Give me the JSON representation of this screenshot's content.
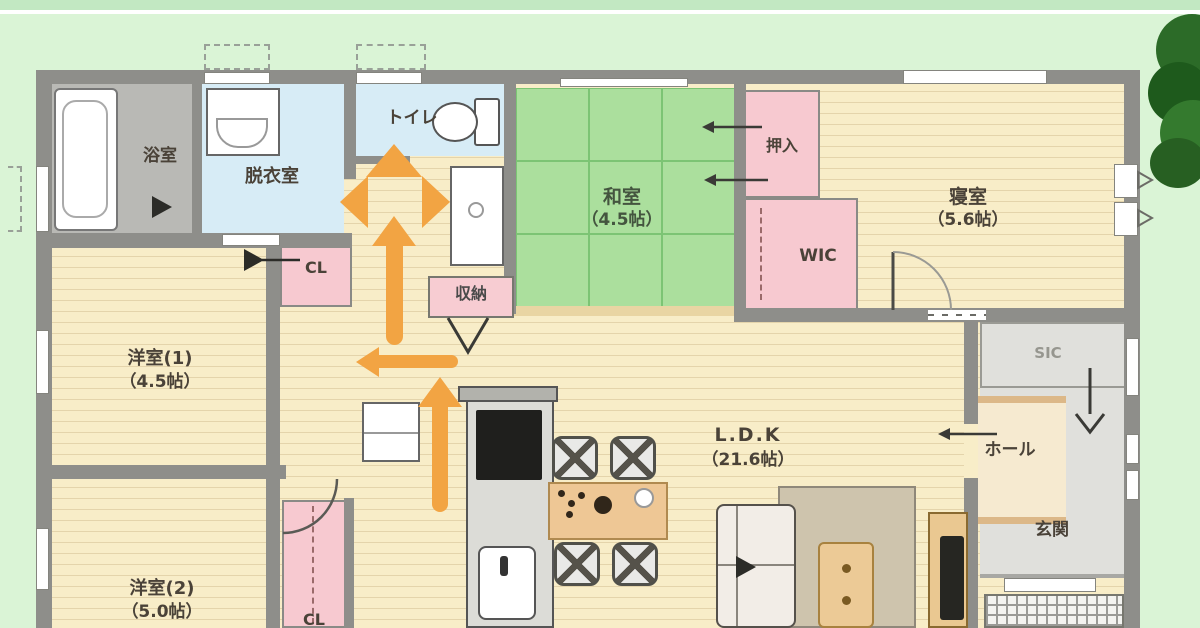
{
  "type": "japanese-floor-plan",
  "rooms": {
    "bath": {
      "label": "浴室"
    },
    "datsui": {
      "label": "脱衣室"
    },
    "toilet": {
      "label": "トイレ"
    },
    "washitsu": {
      "label": "和室",
      "size": "（4.5帖）"
    },
    "oshiire": {
      "label": "押入"
    },
    "wic": {
      "label": "WIC"
    },
    "shinshitsu": {
      "label": "寝室",
      "size": "（5.6帖）"
    },
    "yoshitsu1": {
      "label": "洋室(1)",
      "size": "（4.5帖）"
    },
    "yoshitsu2": {
      "label": "洋室(2)",
      "size": "（5.0帖）"
    },
    "cl1": {
      "label": "CL"
    },
    "cl2": {
      "label": "CL"
    },
    "shuno": {
      "label": "収納"
    },
    "ldk": {
      "label": "L.D.K",
      "size": "（21.6帖）"
    },
    "hall": {
      "label": "ホール"
    },
    "genkan": {
      "label": "玄関"
    },
    "sic": {
      "label": "SIC"
    }
  },
  "flow_arrows": {
    "color": "#F2A443",
    "items": [
      {
        "id": "junction-marker",
        "shape": "three-way-diamond",
        "directions": [
          "up",
          "left",
          "right"
        ],
        "location": "washroom-corridor-near-toilet"
      },
      {
        "id": "arrow-up-corridor",
        "direction": "up",
        "location": "corridor-toward-washroom"
      },
      {
        "id": "arrow-left-hallway",
        "direction": "left",
        "location": "hallway-toward-west-rooms"
      },
      {
        "id": "arrow-up-kitchen",
        "direction": "up",
        "location": "passage-beside-kitchen"
      }
    ]
  },
  "colors": {
    "arrow": "#F2A443",
    "tatami_green": "#ABDF9D",
    "floor_wood": "#F8EDC8",
    "closet_pink": "#F7C9D0",
    "water_room_blue": "#D7ECF6",
    "wall_gray": "#8E8E8A",
    "yard_green": "#DAF4D6",
    "top_band_green": "#C2E8C2"
  }
}
